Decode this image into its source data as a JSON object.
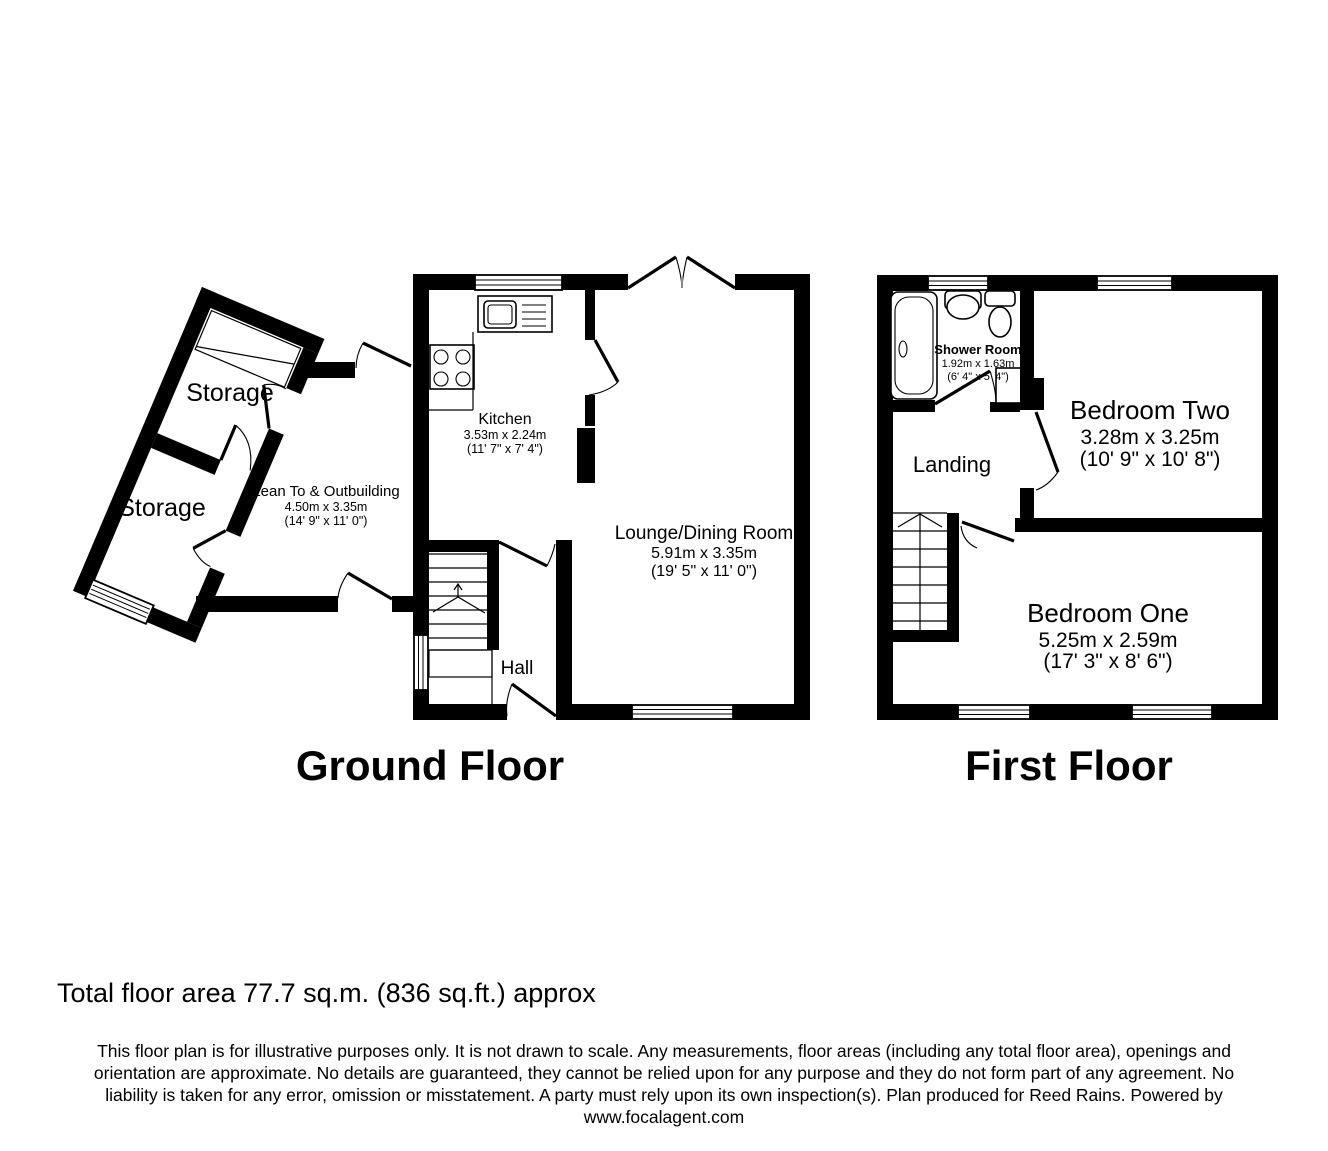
{
  "ground_floor": {
    "title": "Ground Floor",
    "rooms": {
      "storage_one": {
        "name": "Storage"
      },
      "storage_two": {
        "name": "Storage"
      },
      "lean_to": {
        "name": "Lean To & Outbuilding",
        "dims_m": "4.50m x 3.35m",
        "dims_ft": "(14' 9\" x 11' 0\")"
      },
      "kitchen": {
        "name": "Kitchen",
        "dims_m": "3.53m x 2.24m",
        "dims_ft": "(11' 7\" x 7' 4\")"
      },
      "lounge": {
        "name": "Lounge/Dining Room",
        "dims_m": "5.91m x 3.35m",
        "dims_ft": "(19' 5\" x 11' 0\")"
      },
      "hall": {
        "name": "Hall"
      }
    }
  },
  "first_floor": {
    "title": "First Floor",
    "rooms": {
      "shower_room": {
        "name": "Shower Room",
        "dims_m": "1.92m x 1.63m",
        "dims_ft": "(6' 4\" x 5' 4\")"
      },
      "landing": {
        "name": "Landing"
      },
      "bedroom_two": {
        "name": "Bedroom Two",
        "dims_m": "3.28m x 3.25m",
        "dims_ft": "(10' 9\" x 10' 8\")"
      },
      "bedroom_one": {
        "name": "Bedroom One",
        "dims_m": "5.25m x 2.59m",
        "dims_ft": "(17' 3\" x 8' 6\")"
      }
    }
  },
  "footer": {
    "total_area": "Total floor area 77.7 sq.m. (836 sq.ft.) approx",
    "disclaimer_lines": [
      "This floor plan is for illustrative purposes only. It is not drawn to scale. Any measurements, floor areas (including any total floor area), openings and",
      "orientation are approximate. No details are guaranteed, they cannot be relied upon for any purpose and they do not form part of any agreement. No",
      "liability is taken for any error, omission or misstatement. A party must rely upon its own inspection(s). Plan produced for Reed Rains. Powered by",
      "www.focalagent.com"
    ]
  },
  "colors": {
    "wall": "#000000",
    "background": "#ffffff"
  }
}
